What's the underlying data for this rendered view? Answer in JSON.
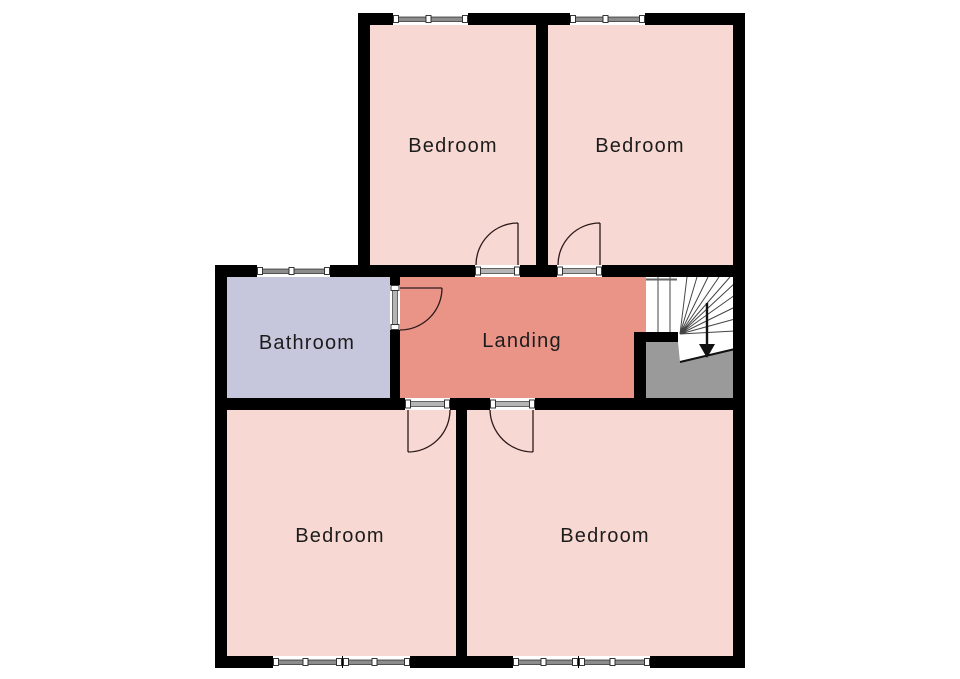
{
  "plan": {
    "labels": {
      "bedroom_top_left": "Bedroom",
      "bedroom_top_right": "Bedroom",
      "bathroom": "Bathroom",
      "landing": "Landing",
      "bedroom_bottom_left": "Bedroom",
      "bedroom_bottom_right": "Bedroom"
    },
    "icons": {
      "stairs_direction": "down-arrow"
    },
    "colors": {
      "bedroom_fill": "#f8d8d2",
      "landing_fill": "#ea9488",
      "bathroom_fill": "#c6c7dd",
      "stair_fill": "#ffffff",
      "stair_void_fill": "#9a9a9a",
      "wall": "#000000",
      "window_glass": "#8c8c8c",
      "door_line": "#2d1a1a",
      "label_text": "#1c1c1c",
      "background": "#ffffff"
    }
  }
}
